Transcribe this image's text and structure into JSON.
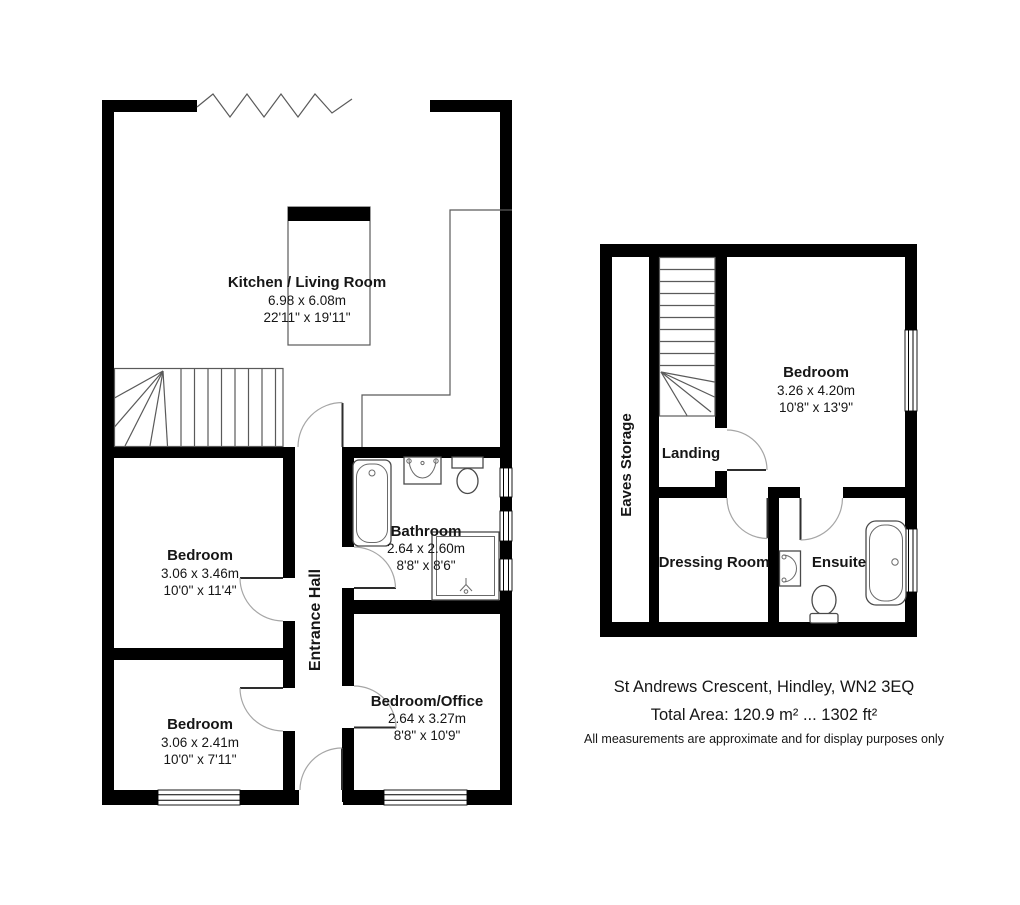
{
  "ground_floor": {
    "kitchen_living": {
      "name": "Kitchen / Living Room",
      "metric": "6.98 x 6.08m",
      "imperial": "22'11\" x 19'11\""
    },
    "bedroom_1": {
      "name": "Bedroom",
      "metric": "3.06 x 3.46m",
      "imperial": "10'0\" x 11'4\""
    },
    "bedroom_2": {
      "name": "Bedroom",
      "metric": "3.06 x 2.41m",
      "imperial": "10'0\" x 7'11\""
    },
    "bathroom": {
      "name": "Bathroom",
      "metric": "2.64 x 2.60m",
      "imperial": "8'8\" x 8'6\""
    },
    "bedroom_office": {
      "name": "Bedroom/Office",
      "metric": "2.64 x 3.27m",
      "imperial": "8'8\" x 10'9\""
    },
    "entrance_hall": {
      "name": "Entrance Hall"
    }
  },
  "first_floor": {
    "bedroom": {
      "name": "Bedroom",
      "metric": "3.26 x 4.20m",
      "imperial": "10'8\" x 13'9\""
    },
    "landing": {
      "name": "Landing"
    },
    "dressing_room": {
      "name": "Dressing Room"
    },
    "ensuite": {
      "name": "Ensuite"
    },
    "eaves_storage": {
      "name": "Eaves Storage"
    }
  },
  "footer": {
    "address": "St Andrews Crescent, Hindley, WN2 3EQ",
    "total_area": "Total Area: 120.9 m² ... 1302 ft²",
    "disclaimer": "All measurements are approximate and for display purposes only"
  },
  "colors": {
    "walls": "#000000",
    "background": "#ffffff",
    "detail_lines": "#5a5a5a",
    "door_arcs": "#a6a6a6",
    "text": "#161616"
  }
}
